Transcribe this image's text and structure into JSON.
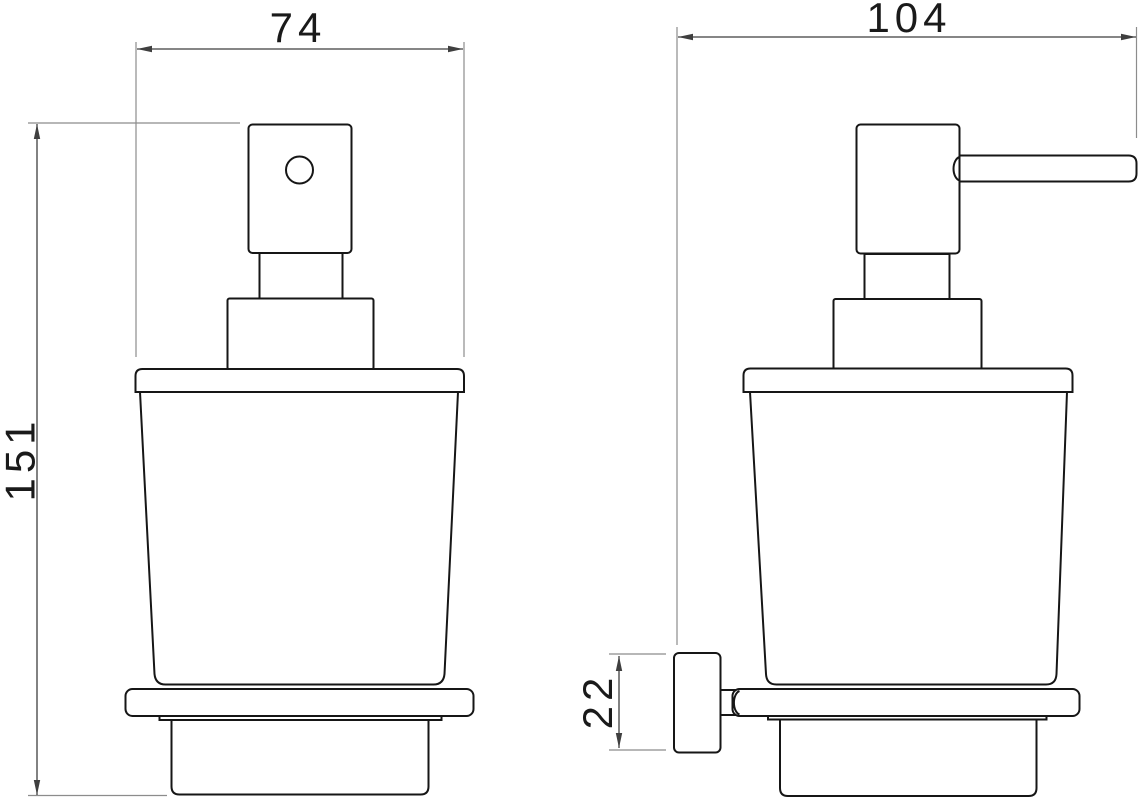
{
  "drawing": {
    "kind": "technical dimension drawing",
    "subject": "wall-mounted glass soap dispenser, front view (left) and side view (right)"
  },
  "dimensions": {
    "front_width": {
      "label": "74",
      "orientation": "horizontal"
    },
    "overall_depth": {
      "label": "104",
      "orientation": "horizontal"
    },
    "overall_height": {
      "label": "151",
      "orientation": "vertical"
    },
    "wall_plate_depth": {
      "label": "22",
      "orientation": "vertical"
    }
  },
  "colors": {
    "background": "#ffffff",
    "outline": "#161616",
    "dimension": "#3f3f3f",
    "extension": "#8c8c8c",
    "text": "#1a1a1a"
  }
}
